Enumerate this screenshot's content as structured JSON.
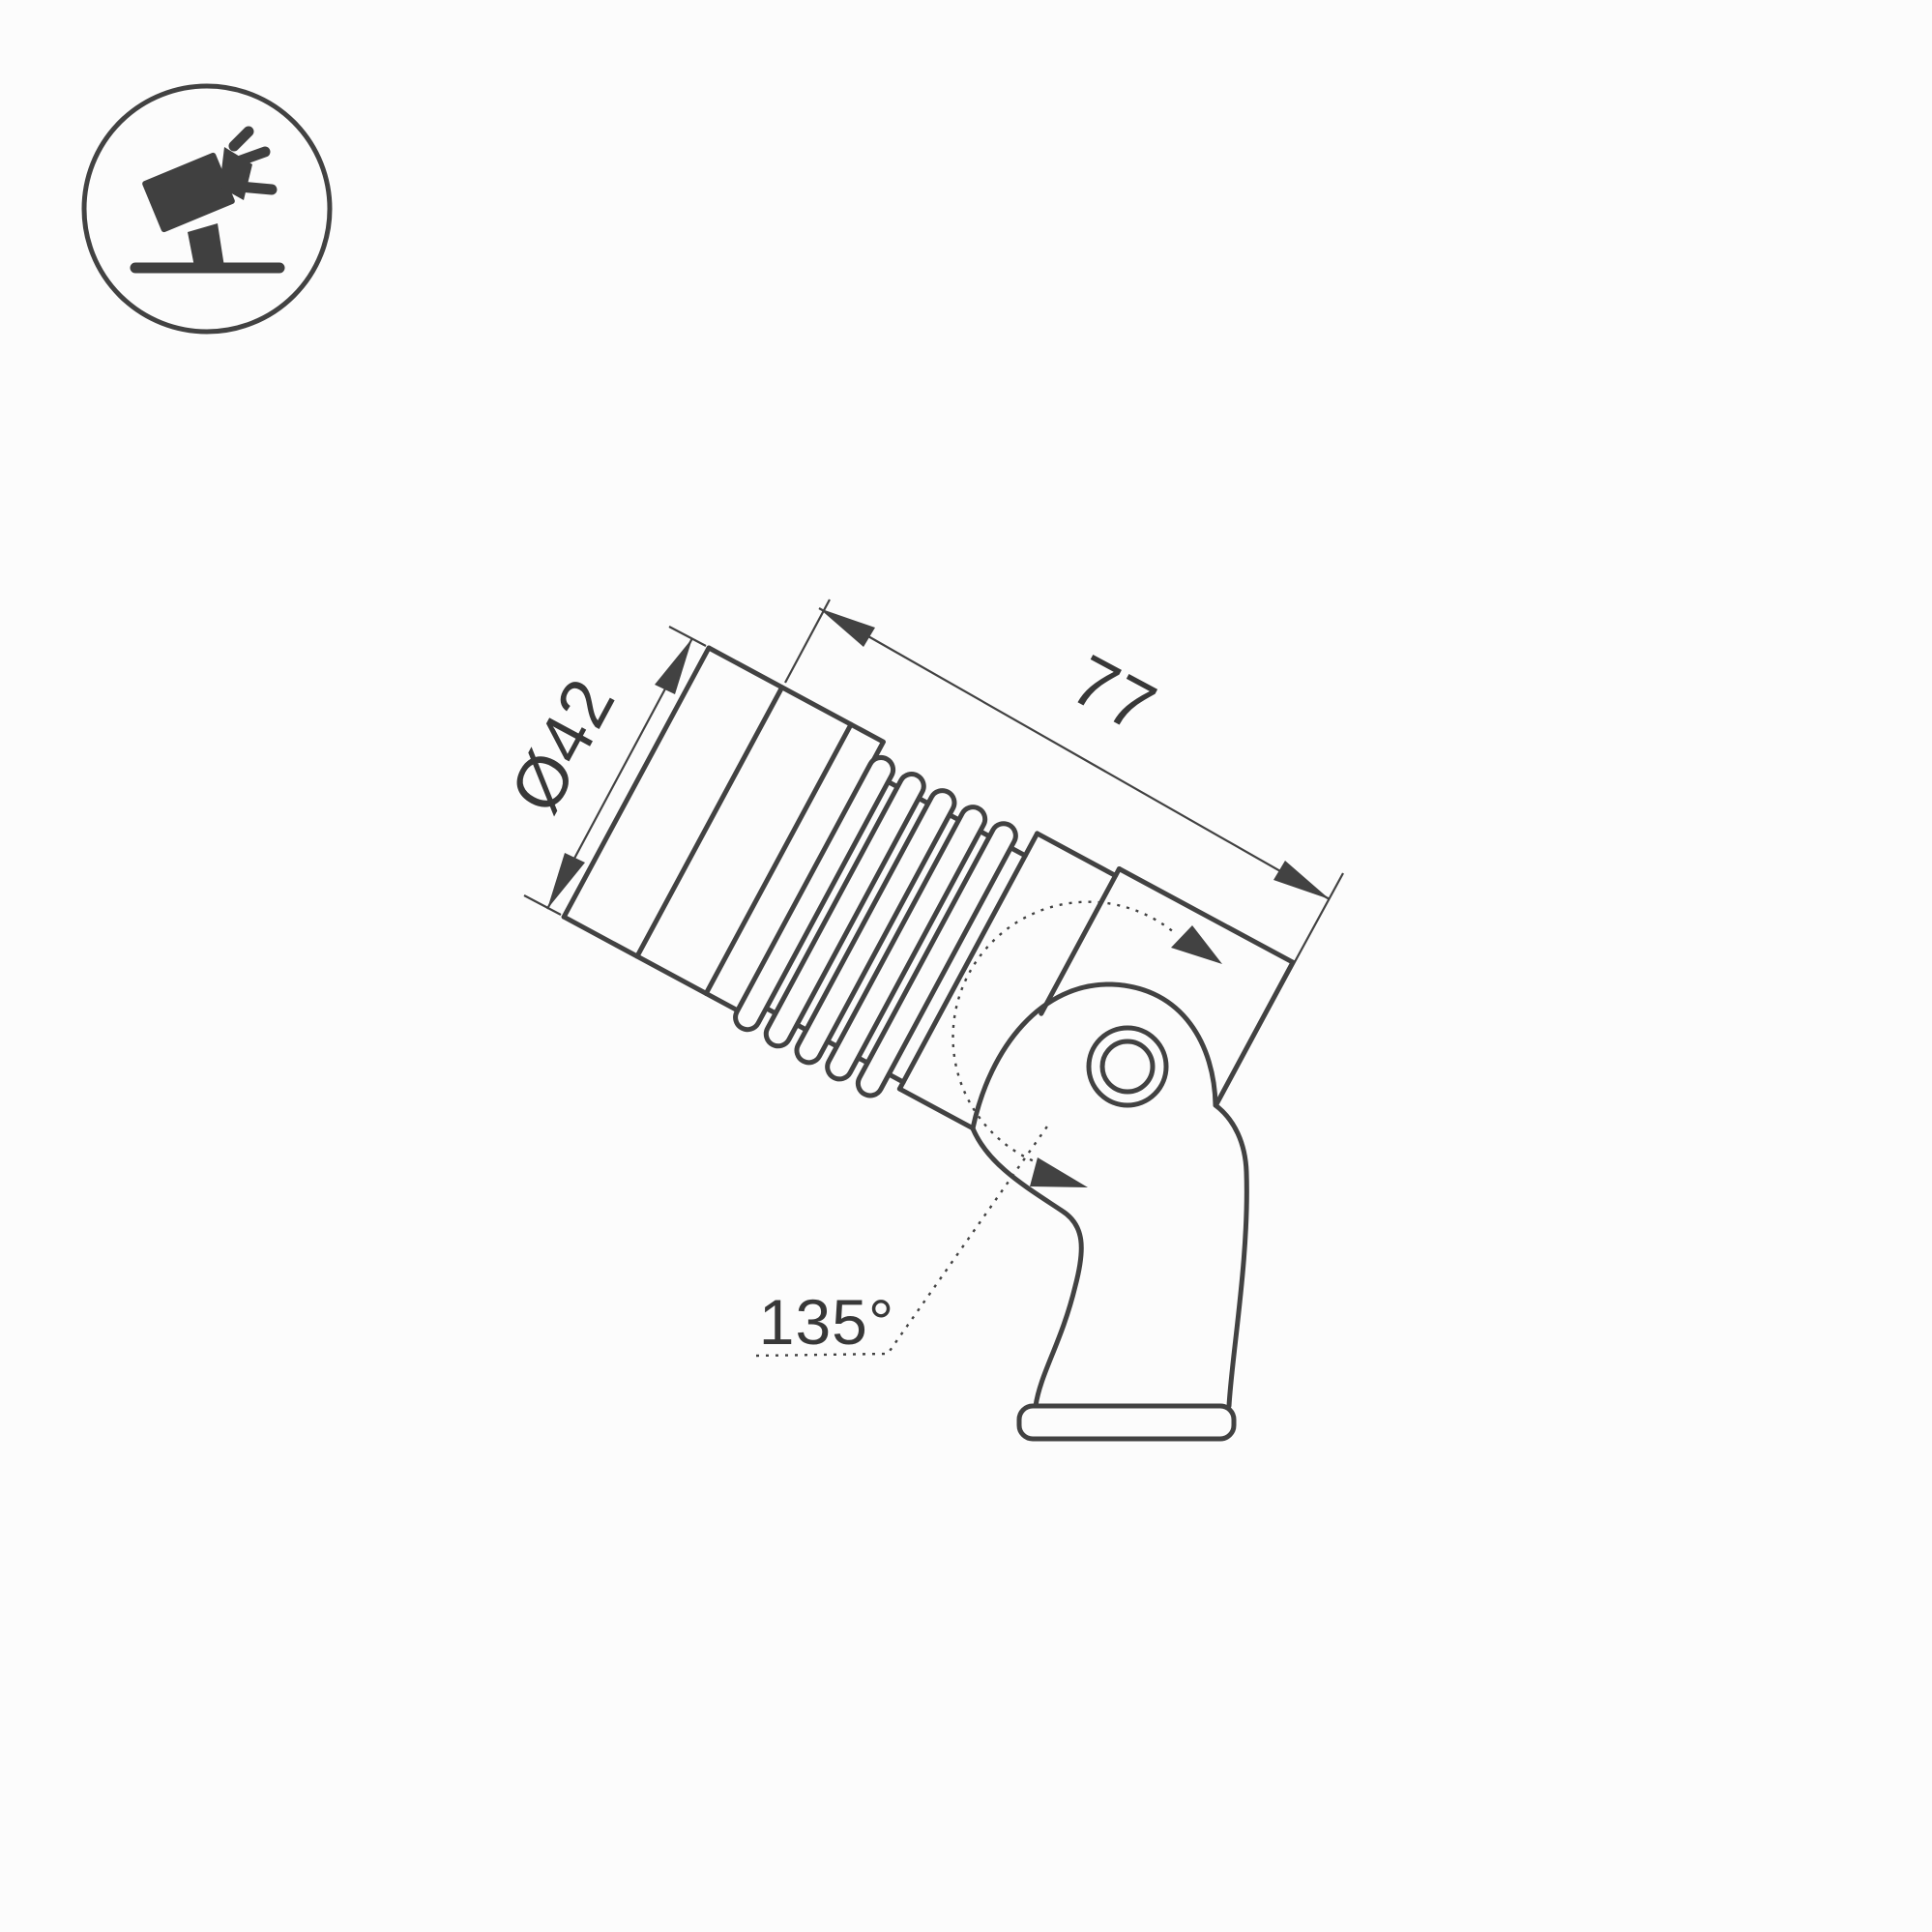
{
  "colors": {
    "background": "#fcfcfc",
    "line": "#424242",
    "text": "#383838",
    "icon": "#404040"
  },
  "icon": {
    "name": "tilted-spotlight-on-stand-icon"
  },
  "annotations": {
    "diameter": "Ø42",
    "length": "77",
    "angle": "135°"
  },
  "drawing": {
    "type": "technical-dimension-drawing",
    "subject": "ground spotlight luminaire, side view, tilted on mounting bracket",
    "tilt_degrees": 28.3,
    "fins_count": 5,
    "dimensions_mm": {
      "diameter": 42,
      "length": 77,
      "swivel_angle_deg": 135
    }
  }
}
